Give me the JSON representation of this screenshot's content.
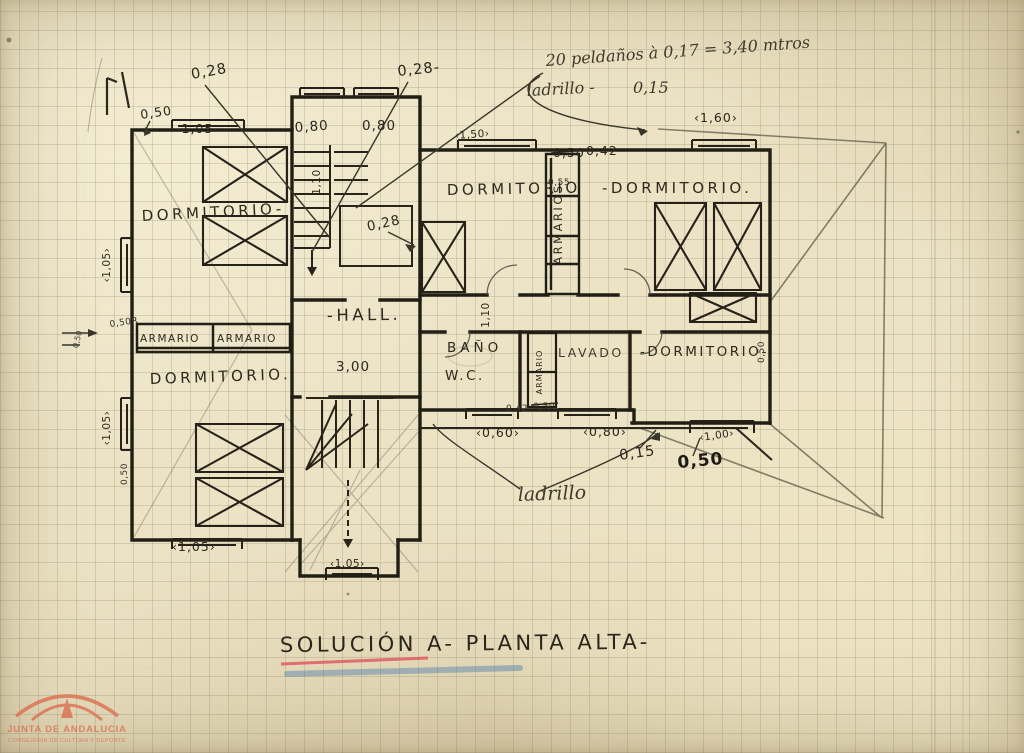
{
  "title": "SOLUCIÓN  A-  PLANTA  ALTA-",
  "notes": {
    "steps": "20 peldaños  à 0,17 = 3,40  mtros",
    "brick_label": "ladrillo  -",
    "brick_value": "0,15",
    "brick_bottom": "ladrillo"
  },
  "rooms": {
    "dorm_tl": "DORMITORIO-",
    "dorm_bl": "DORMITORIO.",
    "dorm_tc": "DORMITORIO",
    "dorm_tr": "-DORMITORIO.",
    "dorm_r": "-DORMITORIO-",
    "hall": "-HALL.",
    "bano": "BAÑO",
    "wc": "W.C.",
    "lavado": "LAVADO",
    "armario_l1": "ARMARIO",
    "armario_l2": "ARMARIO",
    "armarios_c": "ARMARIOS",
    "armario_b": "ARMARIO"
  },
  "dims": {
    "d028_tl": "0,28",
    "d050_tl": "0,50",
    "d105_t": "-1,05-",
    "d080_a": "0,80",
    "d080_b": "0,80",
    "d028_tr": "0,28-",
    "d150": "‹1,50›",
    "d050_x": "0,50",
    "d042": "0,42",
    "d055": "0,55",
    "d160": "‹1,60›",
    "d110_a": "1,10",
    "d028_m": "0,28",
    "d110_b": "1,10",
    "d300": "3,00",
    "d042_b": "0,42",
    "d050_b2": "0,50",
    "d060": "‹0,60›",
    "d080_c": "‹0,80›",
    "d015_b": "0,15",
    "d050_big": "0,50",
    "d100": "‹1,00›",
    "d105_bl": "‹1,05›",
    "d105_bc": "‹1,05›",
    "d105_l1": "‹1,05›",
    "d105_l2": "‹1,05›",
    "d050_l1": "0,50R",
    "d050_l2": "0,50",
    "d050_l3": "0,50",
    "d050_r": "0,50"
  },
  "watermark": {
    "line1": "JUNTA DE ANDALUCIA",
    "line2": "CONSEJERIA DE CULTURA Y DEPORTE"
  },
  "colors": {
    "paper": "#ece3c5",
    "ink": "#26221a",
    "pencil": "#6b6656",
    "red_underline": "#e05a62",
    "blue_underline": "#4f7fae",
    "stamp": "#dc6f52"
  }
}
